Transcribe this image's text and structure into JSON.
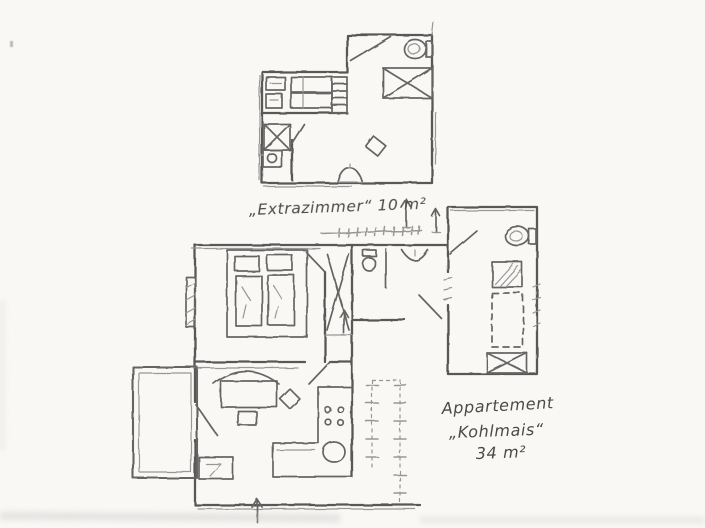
{
  "paper": {
    "background_color": "#fbfaf7",
    "pencil_color": "#565656"
  },
  "upper_plan": {
    "caption": "„Extrazimmer“ 10 m²",
    "room_name": "Extrazimmer",
    "area_label": "10 m²",
    "fixture_icons": [
      "toilet",
      "shower",
      "bed",
      "bed",
      "ladder",
      "shelf",
      "corner-shower",
      "washbasin",
      "sink",
      "stool",
      "door-swing",
      "up-arrow"
    ]
  },
  "lower_plan": {
    "caption_lines": [
      "Appartement",
      "„Kohlmais“",
      "34 m²"
    ],
    "apartment_name": "Kohlmais",
    "area_label": "34 m²",
    "fixture_icons": [
      "double-bed",
      "toilet",
      "washbasin",
      "shower",
      "stove",
      "kitchen-sink",
      "sofa-bench",
      "dining-table",
      "side-table",
      "chair",
      "entry-bench",
      "balcony",
      "stairs",
      "entrance-arrow",
      "window",
      "door-swing"
    ]
  }
}
